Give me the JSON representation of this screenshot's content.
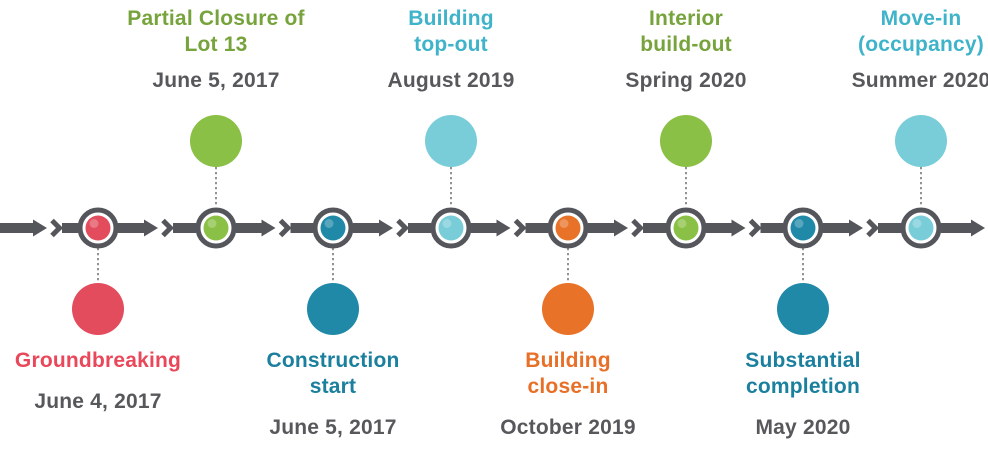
{
  "background_color": "#ffffff",
  "timeline": {
    "bar_color": "#54565b",
    "ring_color": "#54565b",
    "connector_color": "#85878a",
    "date_color": "#57585b",
    "events": [
      {
        "id": "groundbreaking",
        "title": "Groundbreaking",
        "date": "June 4, 2017",
        "side": "below",
        "color": "#e24c5c",
        "text_color": "#e9475a"
      },
      {
        "id": "partial-closure-lot-13",
        "title": "Partial Closure of\nLot 13",
        "date": "June 5, 2017",
        "side": "above",
        "color": "#8ac045",
        "text_color": "#76a33b"
      },
      {
        "id": "construction-start",
        "title": "Construction\nstart",
        "date": "June 5, 2017",
        "side": "below",
        "color": "#2089a8",
        "text_color": "#1b7f9e"
      },
      {
        "id": "building-top-out",
        "title": "Building\ntop-out",
        "date": "August 2019",
        "side": "above",
        "color": "#79cdd8",
        "text_color": "#3fb3ca"
      },
      {
        "id": "building-close-in",
        "title": "Building\nclose-in",
        "date": "October 2019",
        "side": "below",
        "color": "#e87227",
        "text_color": "#e86f27"
      },
      {
        "id": "interior-build-out",
        "title": "Interior\nbuild-out",
        "date": "Spring 2020",
        "side": "above",
        "color": "#8ac045",
        "text_color": "#76a33b"
      },
      {
        "id": "substantial-completion",
        "title": "Substantial\ncompletion",
        "date": "May 2020",
        "side": "below",
        "color": "#2089a8",
        "text_color": "#1b7f9e"
      },
      {
        "id": "move-in",
        "title": "Move-in\n(occupancy)",
        "date": "Summer 2020",
        "side": "above",
        "color": "#79cdd8",
        "text_color": "#3fb3ca"
      }
    ]
  }
}
